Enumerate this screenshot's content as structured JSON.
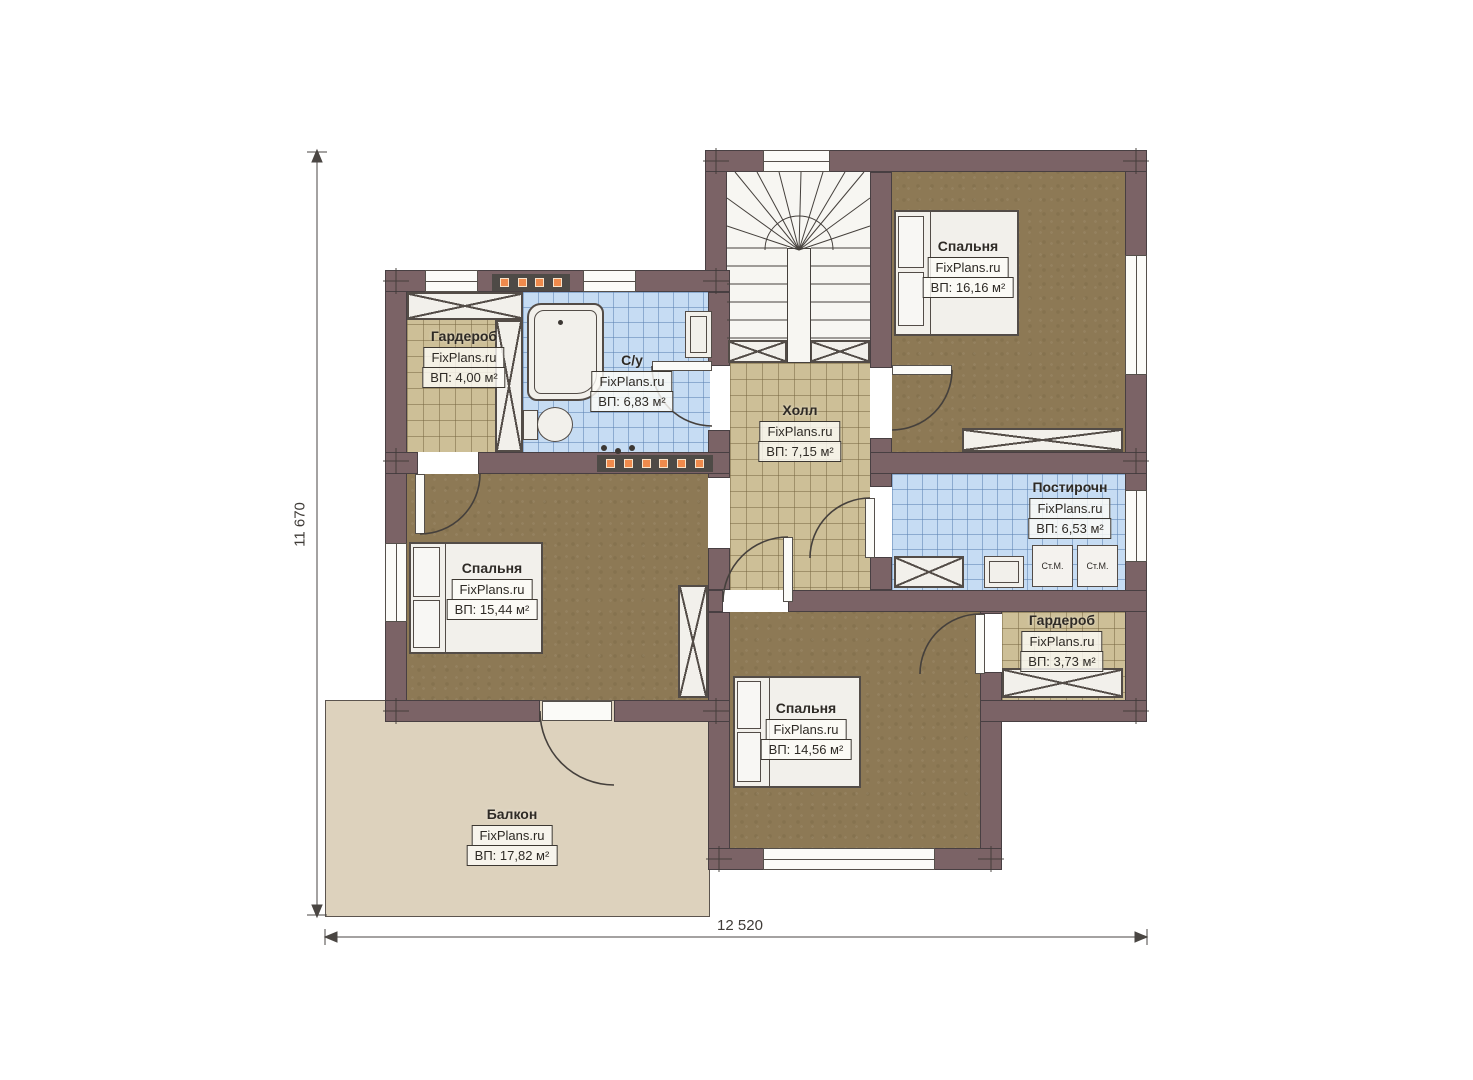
{
  "watermark": "FixPlans.ru",
  "dimensions": {
    "width_label": "12 520",
    "height_label": "11 670"
  },
  "rooms": {
    "wardrobe_top": {
      "name": "Гардероб",
      "area": "ВП: 4,00 м²"
    },
    "bathroom": {
      "name": "С/у",
      "area": "ВП: 6,83 м²"
    },
    "hall": {
      "name": "Холл",
      "area": "ВП: 7,15 м²"
    },
    "bedroom_top_right": {
      "name": "Спальня",
      "area": "ВП: 16,16 м²"
    },
    "laundry": {
      "name": "Постирочн",
      "area": "ВП: 6,53 м²"
    },
    "wardrobe_right": {
      "name": "Гардероб",
      "area": "ВП: 3,73 м²"
    },
    "bedroom_left": {
      "name": "Спальня",
      "area": "ВП: 15,44 м²"
    },
    "bedroom_bottom": {
      "name": "Спальня",
      "area": "ВП: 14,56 м²"
    },
    "balcony": {
      "name": "Балкон",
      "area": "ВП: 17,82 м²"
    }
  },
  "appliances": {
    "washing_machine": "Ст.М."
  },
  "palette": {
    "wall": "#7b6366",
    "floor_wood": "#8d7955",
    "tile_tan": "#cdbf97",
    "tile_blue": "#c6dcf3",
    "balcony": "#ddd2bd",
    "heat_accent": "#ef8a4c"
  }
}
